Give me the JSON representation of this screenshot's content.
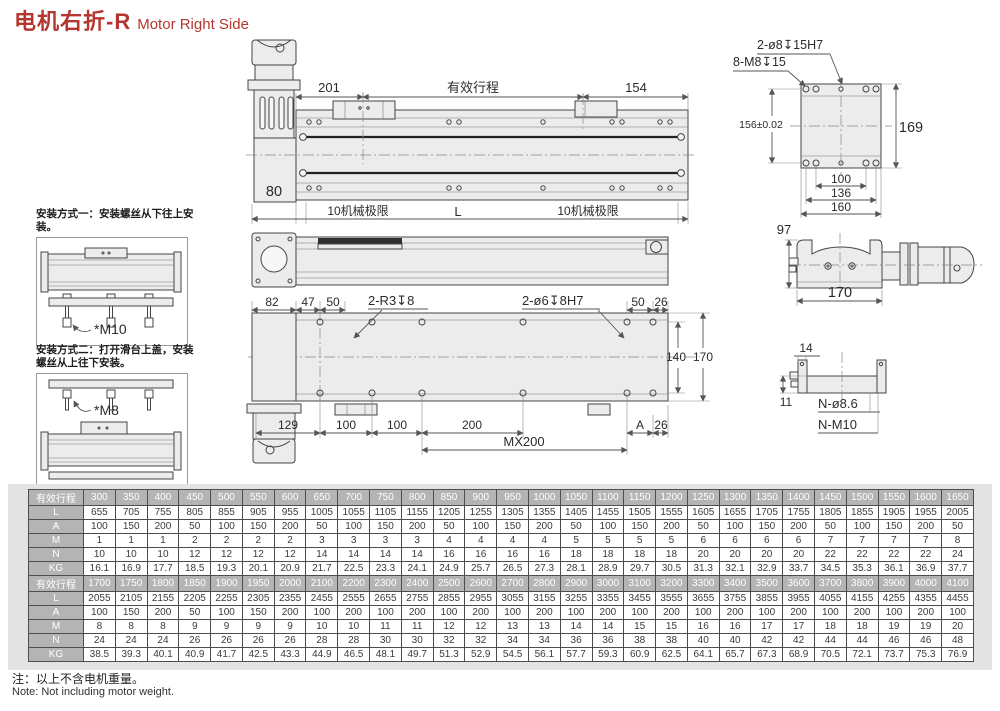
{
  "title": {
    "zh": "电机右折-R",
    "en": "Motor Right Side"
  },
  "install_note1": {
    "title": "安装方式一：安装螺丝从下往上安装。",
    "screw_label": "*M10"
  },
  "install_note2": {
    "title_line1": "安装方式二：打开滑台上盖，安装",
    "title_line2": "螺丝从上往下安装。",
    "screw_label": "*M8"
  },
  "top_view": {
    "dim_left": "201",
    "stroke_label": "有效行程",
    "dim_right": "154",
    "dim_motor_width": "80",
    "limit_left": "10机械极限",
    "length_label": "L",
    "limit_right": "10机械极限"
  },
  "plate_view": {
    "callout_pin_holes": "2-ø8↧15H7",
    "callout_threads": "8-M8↧15",
    "dim_width_tol": "156±0.02",
    "dim_height": "169",
    "dim_b1": "100",
    "dim_b2": "136",
    "dim_b3": "160"
  },
  "section_view": {
    "dim_height": "97",
    "dim_width": "170"
  },
  "bottom_view": {
    "dim_82": "82",
    "dim_47": "47",
    "dim_50_left": "50",
    "callout_r3": "2-R3↧8",
    "callout_dowel": "2-ø6↧8H7",
    "dim_50_right": "50",
    "dim_26_top": "26",
    "dim_140": "140",
    "dim_170": "170",
    "dim_129": "129",
    "dim_100_a": "100",
    "dim_100_b": "100",
    "dim_200": "200",
    "dim_mx": "MX200",
    "dim_A": "A",
    "dim_26_bottom": "26"
  },
  "base_view": {
    "dim_14": "14",
    "dim_11": "11",
    "callout_holes": "N-ø8.6",
    "callout_threads": "N-M10"
  },
  "table": {
    "blocks": [
      {
        "rows": [
          {
            "label": "有效行程",
            "header": true,
            "values": [
              300,
              350,
              400,
              450,
              500,
              550,
              600,
              650,
              700,
              750,
              800,
              850,
              900,
              950,
              1000,
              1050,
              1100,
              1150,
              1200,
              1250,
              1300,
              1350,
              1400,
              1450,
              1500,
              1550,
              1600,
              1650
            ]
          },
          {
            "label": "L",
            "values": [
              655,
              705,
              755,
              805,
              855,
              905,
              955,
              1005,
              1055,
              1105,
              1155,
              1205,
              1255,
              1305,
              1355,
              1405,
              1455,
              1505,
              1555,
              1605,
              1655,
              1705,
              1755,
              1805,
              1855,
              1905,
              1955,
              2005
            ]
          },
          {
            "label": "A",
            "values": [
              100,
              150,
              200,
              50,
              100,
              150,
              200,
              50,
              100,
              150,
              200,
              50,
              100,
              150,
              200,
              50,
              100,
              150,
              200,
              50,
              100,
              150,
              200,
              50,
              100,
              150,
              200,
              50
            ]
          },
          {
            "label": "M",
            "values": [
              1,
              1,
              1,
              2,
              2,
              2,
              2,
              3,
              3,
              3,
              3,
              4,
              4,
              4,
              4,
              5,
              5,
              5,
              5,
              6,
              6,
              6,
              6,
              7,
              7,
              7,
              7,
              8
            ]
          },
          {
            "label": "N",
            "values": [
              10,
              10,
              10,
              12,
              12,
              12,
              12,
              14,
              14,
              14,
              14,
              16,
              16,
              16,
              16,
              18,
              18,
              18,
              18,
              20,
              20,
              20,
              20,
              22,
              22,
              22,
              22,
              24
            ]
          },
          {
            "label": "KG",
            "values": [
              16.1,
              16.9,
              17.7,
              18.5,
              19.3,
              20.1,
              20.9,
              21.7,
              22.5,
              23.3,
              24.1,
              24.9,
              25.7,
              26.5,
              27.3,
              28.1,
              28.9,
              29.7,
              30.5,
              31.3,
              32.1,
              32.9,
              33.7,
              34.5,
              35.3,
              36.1,
              36.9,
              37.7
            ]
          }
        ]
      },
      {
        "rows": [
          {
            "label": "有效行程",
            "header": true,
            "values": [
              1700,
              1750,
              1800,
              1850,
              1900,
              1950,
              2000,
              2100,
              2200,
              2300,
              2400,
              2500,
              2600,
              2700,
              2800,
              2900,
              3000,
              3100,
              3200,
              3300,
              3400,
              3500,
              3600,
              3700,
              3800,
              3900,
              4000,
              4100
            ]
          },
          {
            "label": "L",
            "values": [
              2055,
              2105,
              2155,
              2205,
              2255,
              2305,
              2355,
              2455,
              2555,
              2655,
              2755,
              2855,
              2955,
              3055,
              3155,
              3255,
              3355,
              3455,
              3555,
              3655,
              3755,
              3855,
              3955,
              4055,
              4155,
              4255,
              4355,
              4455
            ]
          },
          {
            "label": "A",
            "values": [
              100,
              150,
              200,
              50,
              100,
              150,
              200,
              100,
              200,
              100,
              200,
              100,
              200,
              100,
              200,
              100,
              200,
              100,
              200,
              100,
              200,
              100,
              200,
              100,
              200,
              100,
              200,
              100
            ]
          },
          {
            "label": "M",
            "values": [
              8,
              8,
              8,
              9,
              9,
              9,
              9,
              10,
              10,
              11,
              11,
              12,
              12,
              13,
              13,
              14,
              14,
              15,
              15,
              16,
              16,
              17,
              17,
              18,
              18,
              19,
              19,
              20
            ]
          },
          {
            "label": "N",
            "values": [
              24,
              24,
              24,
              26,
              26,
              26,
              26,
              28,
              28,
              30,
              30,
              32,
              32,
              34,
              34,
              36,
              36,
              38,
              38,
              40,
              40,
              42,
              42,
              44,
              44,
              46,
              46,
              48
            ]
          },
          {
            "label": "KG",
            "values": [
              38.5,
              39.3,
              40.1,
              40.9,
              41.7,
              42.5,
              43.3,
              44.9,
              46.5,
              48.1,
              49.7,
              51.3,
              52.9,
              54.5,
              56.1,
              57.7,
              59.3,
              60.9,
              62.5,
              64.1,
              65.7,
              67.3,
              68.9,
              70.5,
              72.1,
              73.7,
              75.3,
              76.9
            ]
          }
        ]
      }
    ]
  },
  "footnote": {
    "zh": "注：以上不含电机重量。",
    "en": "Note: Not including motor weight."
  }
}
